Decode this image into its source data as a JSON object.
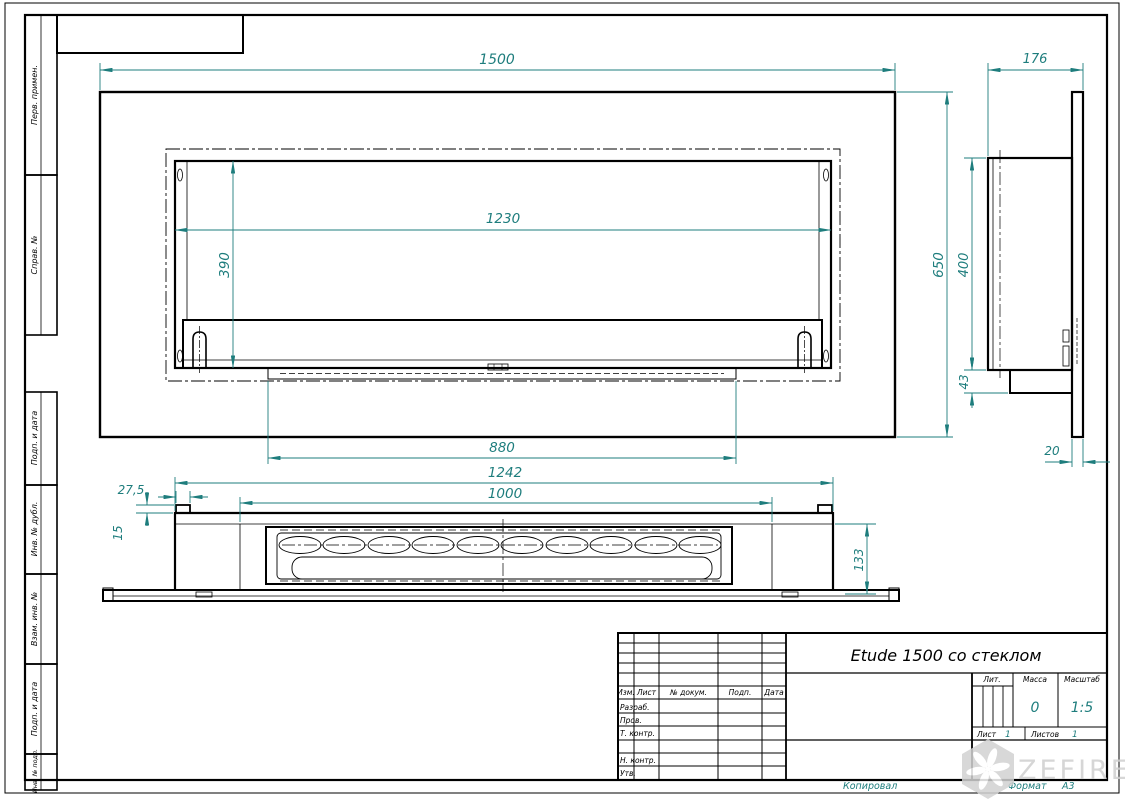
{
  "colors": {
    "line": "#000000",
    "dim": "#1e7d7d",
    "watermark": "#d0d0d0",
    "paper": "#ffffff"
  },
  "front_view": {
    "width": "1500",
    "height": "650",
    "opening_width": "1230",
    "opening_height": "390",
    "lip_width": "880"
  },
  "side_view": {
    "depth": "176",
    "body_height": "400",
    "bracket_height": "43",
    "panel_thickness": "20"
  },
  "bottom_view": {
    "tab_width": "27,5",
    "tab_height": "15",
    "body_length": "1242",
    "burner_length": "1000",
    "body_depth": "133"
  },
  "margin_labels": {
    "perv_primen": "Перв. примен.",
    "sprav_no": "Справ. №",
    "podp_data_1": "Подп. и дата",
    "inv_dubl": "Инв. № дубл.",
    "vzam_inv": "Взам. инв. №",
    "podp_data_2": "Подп. и дата",
    "inv_podl": "Инв. № подл."
  },
  "title_block": {
    "title": "Etude 1500 со стеклом",
    "col_izm": "Изм.",
    "col_list": "Лист",
    "col_dokum": "№ докум.",
    "col_podp": "Подп.",
    "col_data": "Дата",
    "row_razrab": "Разраб.",
    "row_prov": "Пров.",
    "row_tkontr": "Т. контр.",
    "row_nkontr": "Н. контр.",
    "row_utv": "Утв.",
    "lit_label": "Лит.",
    "massa_label": "Масса",
    "massa_value": "0",
    "masshtab_label": "Масштаб",
    "scale_value": "1:5",
    "list_label": "Лист",
    "list_value": "1",
    "listov_label": "Листов",
    "listov_value": "1"
  },
  "footer": {
    "kopiroval": "Копировал",
    "format_label": "Формат",
    "format_value": "А3"
  },
  "watermark_text": "ZEFIRE"
}
